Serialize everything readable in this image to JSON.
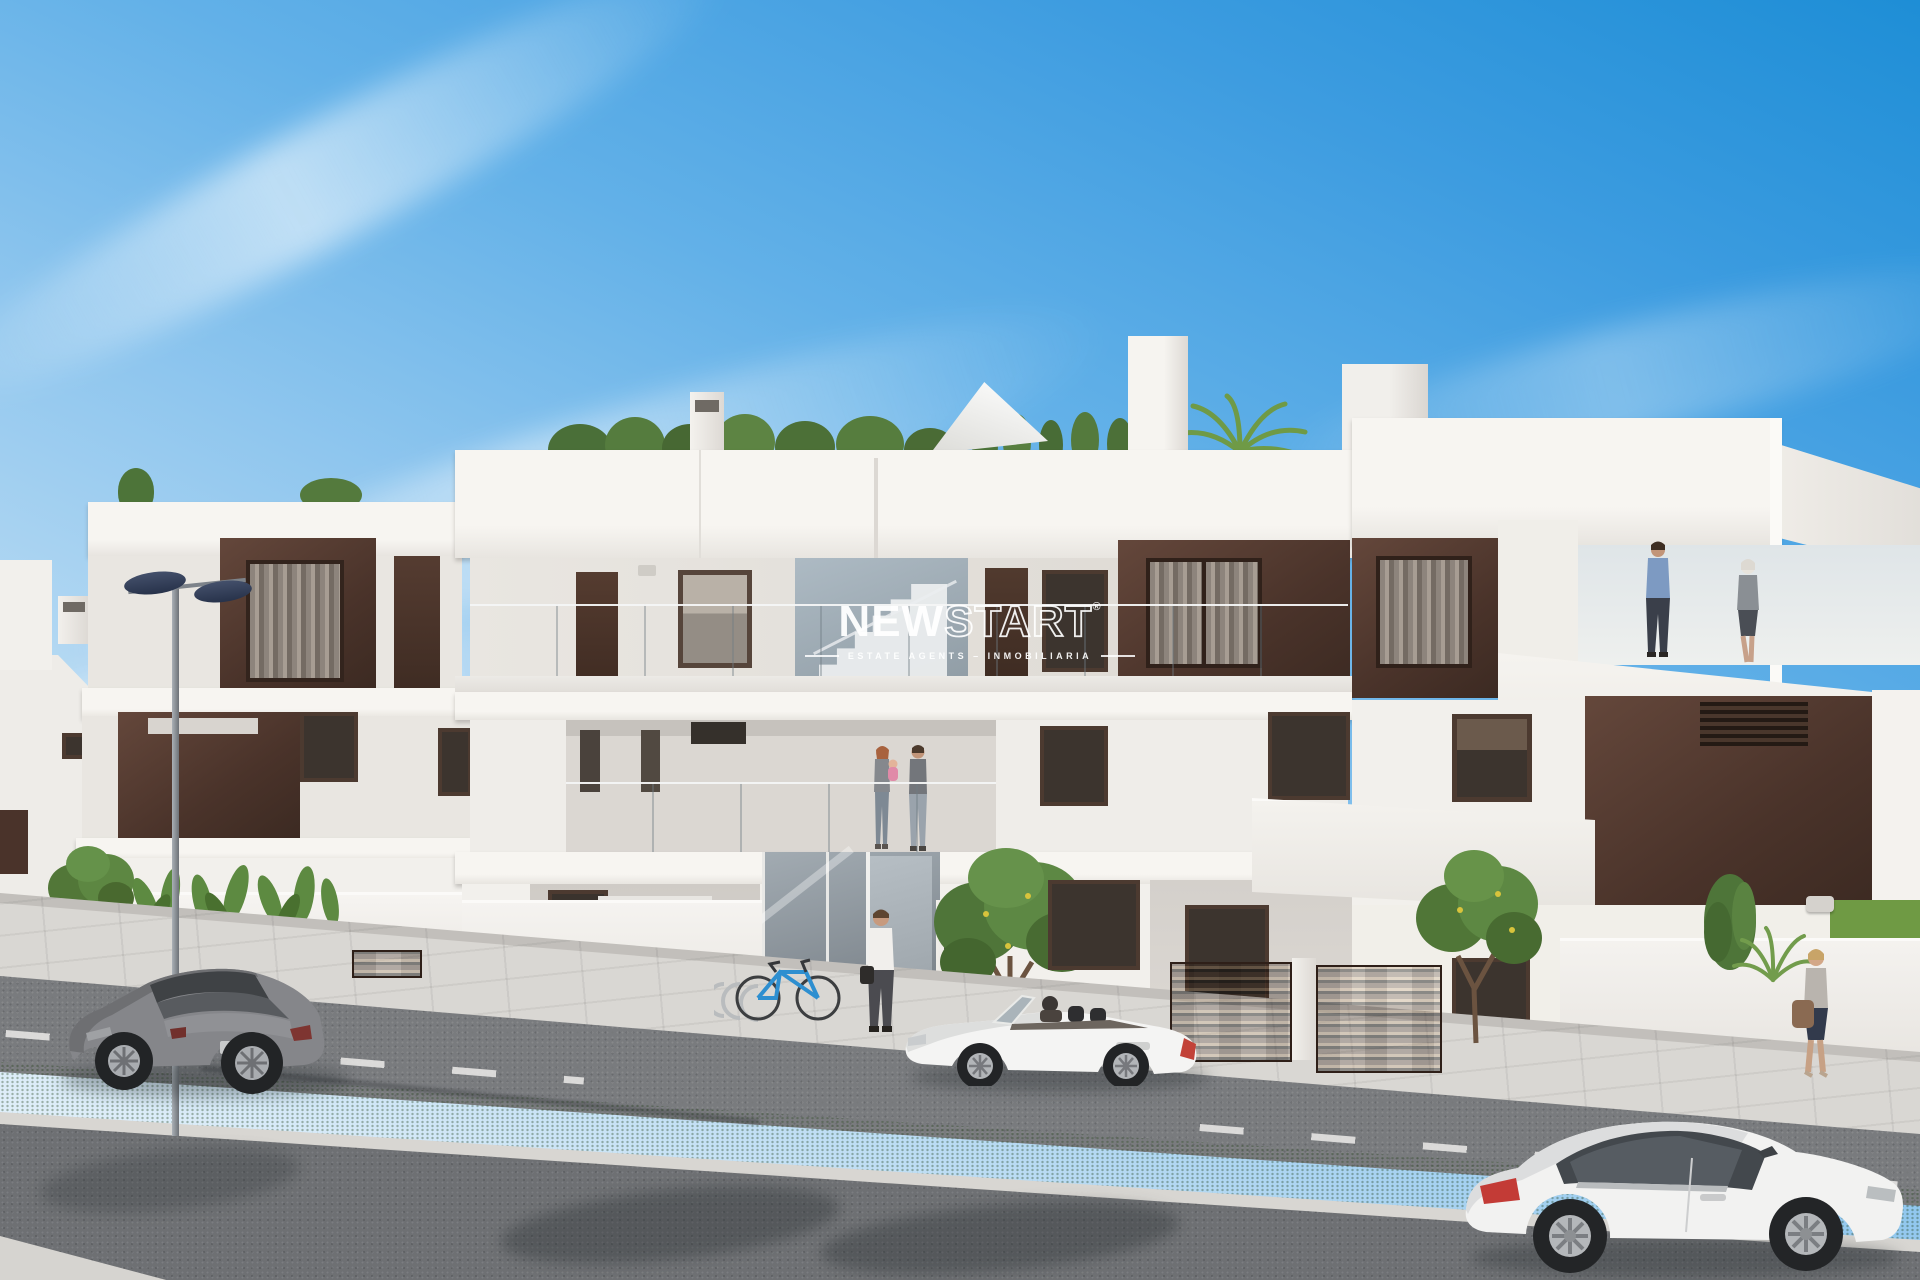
{
  "scene": {
    "type": "architectural-render",
    "description": "3D exterior rendering of a modern white three-level apartment building (new-build residential) on a sunny day with street, cars and people",
    "setting": "street view, blue sky with light cirrus clouds"
  },
  "watermark": {
    "brand_part1": "NEW",
    "brand_part2": "START",
    "registered_mark": "®",
    "tagline": "ESTATE AGENTS – INMOBILIARIA"
  },
  "colors": {
    "sky_top": "#1e8ed6",
    "sky_horizon": "#e9f3fa",
    "facade_white": "#f6f4f0",
    "facade_shade": "#e9e6e1",
    "accent_brown": "#4a332a",
    "glass_balustrade": "#a9bcc8",
    "asphalt": "#797b7e",
    "sidewalk": "#d9d7d3",
    "grass": "#6b9842",
    "watermark_white": "#ffffff"
  },
  "building": {
    "levels": [
      "roof terrace with plants",
      "upper floor with brown panels and glass balustrade",
      "first floor balconies",
      "ground floor with gardens and entrance"
    ],
    "features": [
      "glass entrance lobby with staircase",
      "mailbox pillar",
      "utility cabinets with warning labels",
      "bicycle rack",
      "brown slat garden fences",
      "roof chimneys",
      "shade sail on roof"
    ]
  },
  "vehicles": [
    {
      "name": "gray coupe parked left",
      "color": "gray"
    },
    {
      "name": "white convertible roadster center",
      "color": "white"
    },
    {
      "name": "white coupe driving bottom right",
      "color": "white"
    }
  ],
  "people": [
    {
      "name": "man walking to entrance",
      "clothing": "white shirt, dark trousers, bag"
    },
    {
      "name": "couple with baby on first-floor balcony"
    },
    {
      "name": "businessman on right roof terrace",
      "clothing": "blue shirt"
    },
    {
      "name": "woman on right roof terrace",
      "clothing": "gray suit"
    },
    {
      "name": "woman walking on right sidewalk",
      "clothing": "gray top, dark skirt, brown bag"
    }
  ],
  "vegetation": [
    "rooftop trees and palms",
    "orange trees in front gardens",
    "strelitzia plants",
    "cypress shrubs",
    "street grass median"
  ]
}
